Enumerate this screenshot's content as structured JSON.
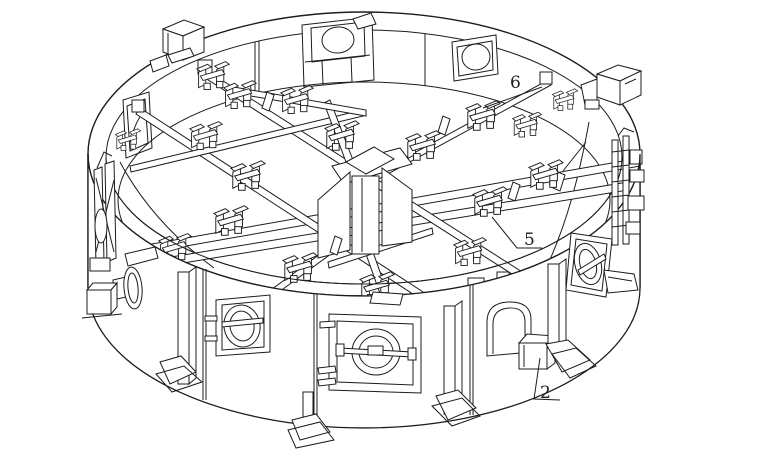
{
  "figure": {
    "kind": "patent-technical-drawing",
    "description": "Isometric line drawing of a circular assembly fixture ring with internal radial beams, toggle clamps, circular hatch mechanisms, windows and support legs",
    "background": "#ffffff",
    "ink": "#1c1c1c"
  },
  "callouts": [
    {
      "id": "callout-6",
      "label": "6",
      "leader": "483,108 542,87"
    },
    {
      "id": "callout-5",
      "label": "5",
      "leader": "492,217 517,248 542,248"
    },
    {
      "id": "callout-2",
      "label": "2",
      "leader": "540,358 534,399 560,400"
    }
  ]
}
